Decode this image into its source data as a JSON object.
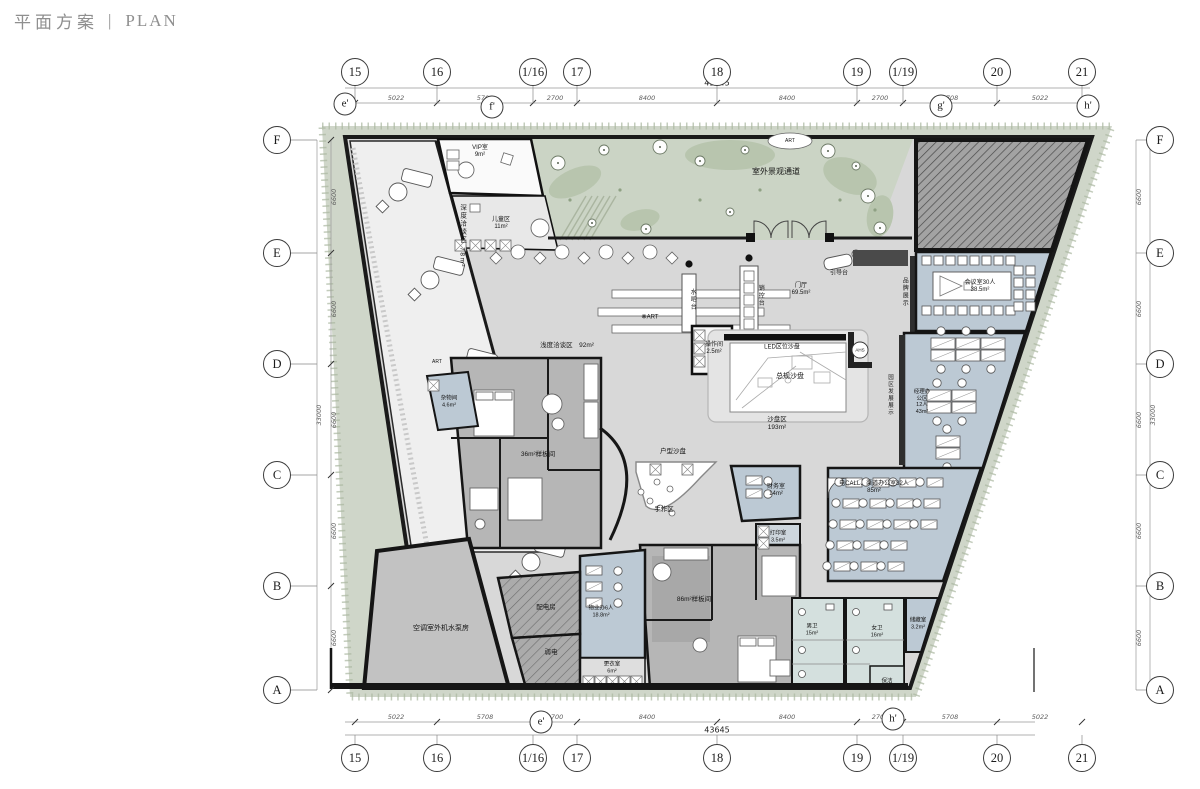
{
  "title": {
    "zh": "平面方案",
    "divider": "|",
    "en": "PLAN"
  },
  "colors": {
    "wall": "#1a1a1a",
    "floor": "#d8d8d8",
    "landscape": "#cfd6c9",
    "landscape_dark": "#b8c5ae",
    "room_blue": "#bcc9d4",
    "room_blue_light": "#d4e0de",
    "hatch_gray": "#a3a3a3",
    "model_gray": "#b6b6b6",
    "title_gray": "#8f8f8f"
  },
  "grid": {
    "top_y": 72,
    "bottom_y": 758,
    "row_x_left": 277,
    "row_x_right": 1160,
    "columns": [
      {
        "label": "15",
        "x": 355
      },
      {
        "label": "16",
        "x": 437
      },
      {
        "label": "1/16",
        "x": 533
      },
      {
        "label": "17",
        "x": 577
      },
      {
        "label": "18",
        "x": 717
      },
      {
        "label": "19",
        "x": 857
      },
      {
        "label": "1/19",
        "x": 903
      },
      {
        "label": "20",
        "x": 997
      },
      {
        "label": "21",
        "x": 1082
      }
    ],
    "rows": [
      {
        "label": "F",
        "y": 140
      },
      {
        "label": "E",
        "y": 253
      },
      {
        "label": "D",
        "y": 364
      },
      {
        "label": "C",
        "y": 475
      },
      {
        "label": "B",
        "y": 586
      },
      {
        "label": "A",
        "y": 690
      }
    ],
    "primes_top": [
      {
        "label": "e'",
        "x": 345,
        "y": 104
      },
      {
        "label": "f'",
        "x": 492,
        "y": 107
      },
      {
        "label": "g'",
        "x": 941,
        "y": 106
      },
      {
        "label": "h'",
        "x": 1088,
        "y": 106
      }
    ],
    "primes_bottom": [
      {
        "label": "e'",
        "x": 541,
        "y": 722
      },
      {
        "label": "h'",
        "x": 893,
        "y": 719
      }
    ],
    "h_segments": [
      {
        "v": "5022",
        "x": 396
      },
      {
        "v": "5708",
        "x": 485
      },
      {
        "v": "2700",
        "x": 555
      },
      {
        "v": "8400",
        "x": 647
      },
      {
        "v": "8400",
        "x": 787
      },
      {
        "v": "2700",
        "x": 880
      },
      {
        "v": "5708",
        "x": 950
      },
      {
        "v": "5022",
        "x": 1040
      }
    ],
    "h_total": {
      "v": "43645",
      "x": 717
    },
    "v_segments": [
      {
        "v": "6600",
        "y": 197
      },
      {
        "v": "6600",
        "y": 309
      },
      {
        "v": "6600",
        "y": 420
      },
      {
        "v": "6600",
        "y": 531
      },
      {
        "v": "6600",
        "y": 638
      }
    ],
    "v_total": "33000"
  },
  "labels": [
    {
      "id": "label-vip-room",
      "x": 480,
      "y": 152,
      "lines": [
        "VIP室",
        "9m²"
      ],
      "size": 6
    },
    {
      "id": "label-kids-area",
      "x": 501,
      "y": 224,
      "lines": [
        "儿童区",
        "11m²"
      ],
      "size": 6
    },
    {
      "id": "label-deep-talk-area",
      "x": 462,
      "y": 236,
      "lines": [
        "深度洽谈区 78m²"
      ],
      "vertical": true,
      "size": 6.5
    },
    {
      "id": "label-shallow-talk-area",
      "x": 567,
      "y": 346,
      "lines": [
        "浅度洽谈区　92m²"
      ],
      "size": 6.5
    },
    {
      "id": "label-outdoor-landscape-path",
      "x": 776,
      "y": 172,
      "lines": [
        "室外景观通道"
      ],
      "size": 8
    },
    {
      "id": "label-guide-desk",
      "x": 839,
      "y": 274,
      "lines": [
        "引导台"
      ],
      "size": 6
    },
    {
      "id": "label-foyer",
      "x": 801,
      "y": 290,
      "lines": [
        "门厅",
        "69.5m²"
      ],
      "size": 6
    },
    {
      "id": "label-sales-control-desk",
      "x": 760,
      "y": 296,
      "lines": [
        "销控台"
      ],
      "vertical": true,
      "size": 6
    },
    {
      "id": "label-water-bar",
      "x": 692,
      "y": 300,
      "lines": [
        "水吧台"
      ],
      "vertical": true,
      "size": 6
    },
    {
      "id": "label-brand-display",
      "x": 904,
      "y": 292,
      "lines": [
        "品牌展示"
      ],
      "vertical": true,
      "size": 6
    },
    {
      "id": "label-meeting-room",
      "x": 980,
      "y": 287,
      "lines": [
        "会议室30人",
        "38.5m²"
      ],
      "size": 6
    },
    {
      "id": "label-operation-room",
      "x": 714,
      "y": 349,
      "lines": [
        "操作间",
        "2.5m²"
      ],
      "size": 6
    },
    {
      "id": "label-led-screen",
      "x": 782,
      "y": 348,
      "lines": [
        "LED区位沙盘"
      ],
      "size": 6
    },
    {
      "id": "label-master-sand-table",
      "x": 790,
      "y": 377,
      "lines": [
        "总规沙盘"
      ],
      "size": 7
    },
    {
      "id": "label-sand-table-area",
      "x": 777,
      "y": 424,
      "lines": [
        "沙盘区",
        "193m²"
      ],
      "size": 6.5
    },
    {
      "id": "label-unit-sand-table",
      "x": 673,
      "y": 452,
      "lines": [
        "户型沙盘"
      ],
      "size": 6.5
    },
    {
      "id": "label-handcraft-area",
      "x": 664,
      "y": 510,
      "lines": [
        "手作区"
      ],
      "size": 6.5
    },
    {
      "id": "label-finance-room",
      "x": 776,
      "y": 491,
      "lines": [
        "财务室",
        "14m²"
      ],
      "size": 6
    },
    {
      "id": "label-print-room",
      "x": 778,
      "y": 537,
      "lines": [
        "打印室",
        "3.5m²"
      ],
      "size": 5.5
    },
    {
      "id": "label-ecall-office",
      "x": 874,
      "y": 488,
      "lines": [
        "电CALL、渠道办公室32人",
        "85m²"
      ],
      "size": 6
    },
    {
      "id": "label-manager-office",
      "x": 922,
      "y": 402,
      "lines": [
        "经理办",
        "公区",
        "12人",
        "43m²"
      ],
      "size": 5.5
    },
    {
      "id": "label-park-dev-display",
      "x": 890,
      "y": 395,
      "lines": [
        "园区发展展示"
      ],
      "vertical": true,
      "size": 5.5
    },
    {
      "id": "label-misc-room",
      "x": 449,
      "y": 402,
      "lines": [
        "杂物间",
        "4.6m²"
      ],
      "size": 5.5
    },
    {
      "id": "label-model-room-36",
      "x": 538,
      "y": 455,
      "lines": [
        "36m²样板间"
      ],
      "size": 6.5
    },
    {
      "id": "label-model-room-86",
      "x": 694,
      "y": 600,
      "lines": [
        "86m²样板间"
      ],
      "size": 6.5
    },
    {
      "id": "label-ac-pump-room",
      "x": 441,
      "y": 629,
      "lines": [
        "空调室外机水泵房"
      ],
      "size": 7
    },
    {
      "id": "label-power-room",
      "x": 546,
      "y": 608,
      "lines": [
        "配电房"
      ],
      "size": 6.5
    },
    {
      "id": "label-weak-current-room",
      "x": 551,
      "y": 653,
      "lines": [
        "弱电"
      ],
      "size": 6.5
    },
    {
      "id": "label-property-office",
      "x": 601,
      "y": 612,
      "lines": [
        "物业办6人",
        "18.8m²"
      ],
      "size": 5.5
    },
    {
      "id": "label-locker-room",
      "x": 612,
      "y": 668,
      "lines": [
        "更衣室",
        "6m²"
      ],
      "size": 5.5
    },
    {
      "id": "label-male-wc",
      "x": 812,
      "y": 630,
      "lines": [
        "男卫",
        "15m²"
      ],
      "size": 5.5
    },
    {
      "id": "label-female-wc",
      "x": 877,
      "y": 632,
      "lines": [
        "女卫",
        "16m²"
      ],
      "size": 5.5
    },
    {
      "id": "label-storage-room",
      "x": 918,
      "y": 624,
      "lines": [
        "储藏室",
        "3.2m²"
      ],
      "size": 5.5
    },
    {
      "id": "label-cleaning-room",
      "x": 887,
      "y": 682,
      "lines": [
        "保洁"
      ],
      "size": 5.5
    },
    {
      "id": "label-art-oval",
      "x": 790,
      "y": 141,
      "lines": [
        "ART"
      ],
      "size": 5
    },
    {
      "id": "label-art-1",
      "x": 650,
      "y": 318,
      "lines": [
        "❋ART"
      ],
      "size": 6
    },
    {
      "id": "label-art-2",
      "x": 437,
      "y": 362,
      "lines": [
        "ART"
      ],
      "size": 5
    },
    {
      "id": "label-ahs-sign",
      "x": 860,
      "y": 350,
      "lines": [
        "AHS"
      ],
      "size": 4.5
    }
  ]
}
